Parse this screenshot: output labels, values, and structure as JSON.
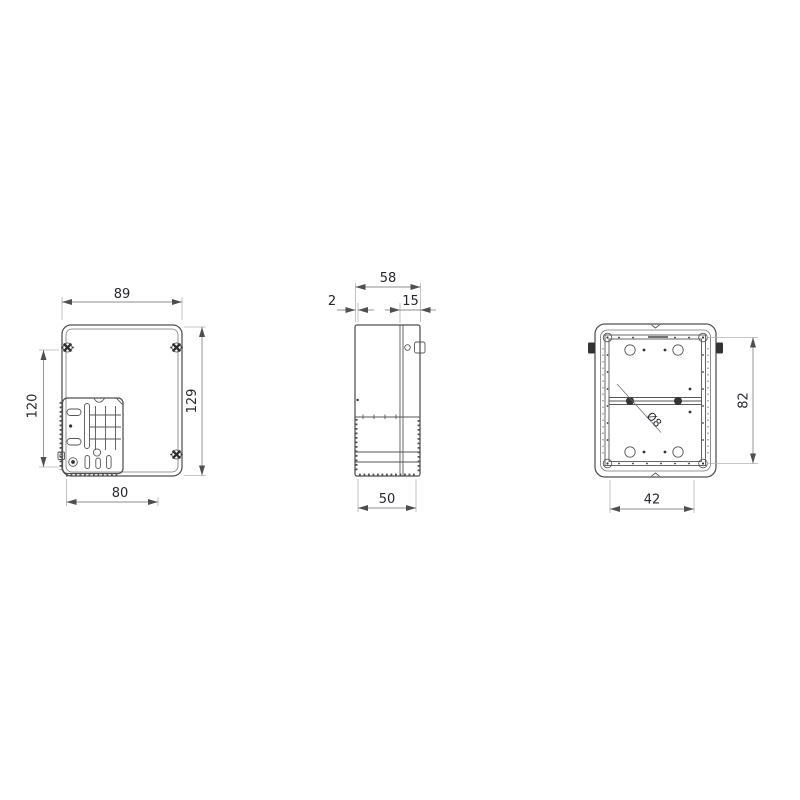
{
  "title": "enclosure-dimension-drawing",
  "background": "#ffffff",
  "line_color": "#4f4f4f",
  "dim_line_color": "#8c8c8c",
  "text_color": "#26262e",
  "views": {
    "front": {
      "name": "front-view",
      "dims": {
        "width_top": "89",
        "height_left": "120",
        "height_right": "129",
        "width_bottom": "80"
      }
    },
    "side": {
      "name": "side-view",
      "dims": {
        "depth_total": "58",
        "lid_lip": "2",
        "rear_depth": "15",
        "base_depth": "50"
      }
    },
    "back": {
      "name": "back-view",
      "dims": {
        "mount_height": "82",
        "hole_diameter": "Ø8",
        "mount_width": "42"
      }
    }
  }
}
